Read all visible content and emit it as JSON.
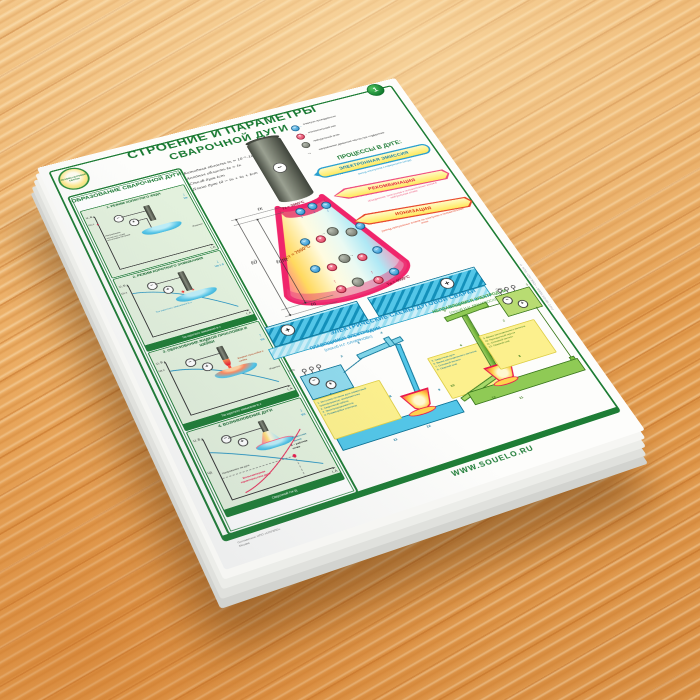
{
  "poster": {
    "badge": "1",
    "logo": {
      "text": "ОСНОВЫ ДУГОВОЙ СВАРКИ"
    },
    "title_line1": "СТРОЕНИЕ И ПАРАМЕТРЫ",
    "title_line2": "СВАРОЧНОЙ ДУГИ",
    "sidebar": {
      "title": "ОБРАЗОВАНИЕ СВАРОЧНОЙ ДУГИ",
      "panels": [
        {
          "title": "1. РЕЖИМ ХОЛОСТОГО ХОДА",
          "axis_y": "U, B",
          "axis_x": "I, A",
          "u_label": "Uх.х",
          "note": "Напряжение холостого хода источника питания",
          "v_label": "Vп",
          "part_label": "Изделие",
          "footer": ""
        },
        {
          "title": "2. РЕЖИМ КОРОТКОГО ЗАМЫКАНИЯ",
          "axis_y": "U, B",
          "axis_x": "I, A",
          "u_label": "Uх.х",
          "note": "Ток короткого замыкания Iк.з",
          "v_label": "Vп ≈ 0",
          "part_label": "Изделие",
          "footer": "Ток короткого замыкания Iк.з"
        },
        {
          "title": "3. ОБРАЗОВАНИЕ ЖИДКОЙ ПРОСЛОЙКИ И ШЕЙКИ",
          "axis_y": "U, B",
          "axis_x": "I, A",
          "u_label": "Uх.х",
          "note": "Жидкая прослойка и шейка",
          "v_label": "Vп",
          "part_label": "Изделие",
          "footer": "Ток короткого замыкания Iк.з"
        },
        {
          "title": "4. ВОЗНИКНОВЕНИЕ ДУГИ",
          "axis_y": "U, B",
          "axis_x": "I, A",
          "u_label": "Uд",
          "note": "Напряжение на дуге",
          "v_label": "Vп",
          "part_label": "Сварочная ванна",
          "footer": "Сварочный ток Iд",
          "vac_label": "Вольтамперная характеристика дуги",
          "point_label": "A – рабочая точка"
        }
      ]
    },
    "formulas": [
      "Катодная область ℓк ≈ 10⁻⁵–10⁻⁴ см",
      "Анодная область ℓа ≈ ℓк",
      "Столб дуги ℓст",
      "Длина дуги ℓд = ℓк + ℓа + ℓст"
    ],
    "arc": {
      "t_cathode": "Tк ≈ 3000°C",
      "t_column": "Tст ≈ 7000°C",
      "t_anode": "Tа ≈ 4000°C",
      "dim_top": "ℓк",
      "dim_arc": "ℓд",
      "dim_column": "ℓст",
      "dim_bottom": "ℓа"
    },
    "legend": {
      "items": [
        {
          "label": "электрон проводимости"
        },
        {
          "label": "положительный ион"
        },
        {
          "label": "нейтральный атом"
        },
        {
          "label": "направление движения частиц при соударении"
        }
      ]
    },
    "processes": {
      "title": "ПРОЦЕССЫ В ДУГЕ:",
      "items": [
        {
          "label": "ЭЛЕКТРОННАЯ ЭМИССИЯ",
          "desc": "выход электронов с поверхности катода"
        },
        {
          "label": "РЕКОМБИНАЦИЯ",
          "desc": "объединение электронов и положительных ионов в нейтральные атомы"
        },
        {
          "label": "ИОНИЗАЦИЯ",
          "desc": "распад нейтральных атомов на электроны и положительные ионы"
        }
      ]
    },
    "schemes": {
      "title": "ЭЛЕКТРИЧЕСКИЕ СХЕМЫ ДУГОВОЙ СВАРКИ",
      "left": {
        "title": "ПЛАВЯЩИМСЯ ЭЛЕКТРОДОМ",
        "subtitle": "(способ Н.Г. СЛАВЯНОВА)",
        "net": "Сеть",
        "legend_a": [
          "1. Источник питания дуги (сварочный трансформатор, выпрямитель)",
          "2. Сварочный кабель",
          "3. Электрододержатель",
          "4. Плавящийся электрод"
        ],
        "legend_b": [
          "5. Сварочная дуга",
          "6. Ванна расплавленного металла",
          "7. Основной металл",
          "8. Сварной шов"
        ],
        "numbers": [
          "1",
          "2",
          "3",
          "4",
          "7",
          "8",
          "9",
          "11",
          "12"
        ]
      },
      "right": {
        "title": "НЕПЛАВЯЩИМСЯ ЭЛЕКТРОДОМ",
        "subtitle": "(способ Н.Н. БЕНАРДОСА)",
        "net": "Сеть",
        "legend": [
          "9. Ванна расплавленного металла",
          "10. Присадочный пруток",
          "11. Основной металл",
          "12. Сварной шов"
        ],
        "numbers": [
          "1",
          "2",
          "5",
          "6",
          "8",
          "10",
          "11",
          "12"
        ]
      }
    },
    "footer": {
      "website": "WWW.SOUELO.RU",
      "credits_line1": "Составители: НПО «СОУЭЛО»",
      "credits_line2": "Москва",
      "side_note": "© НПО «СОУЭЛО» • WWW.SOUELO.RU"
    },
    "symbols": {
      "minus": "−",
      "plus": "+",
      "arrow_down": "↓",
      "arrow_up": "↑",
      "arrow_right": "→",
      "spark": "✶"
    }
  }
}
